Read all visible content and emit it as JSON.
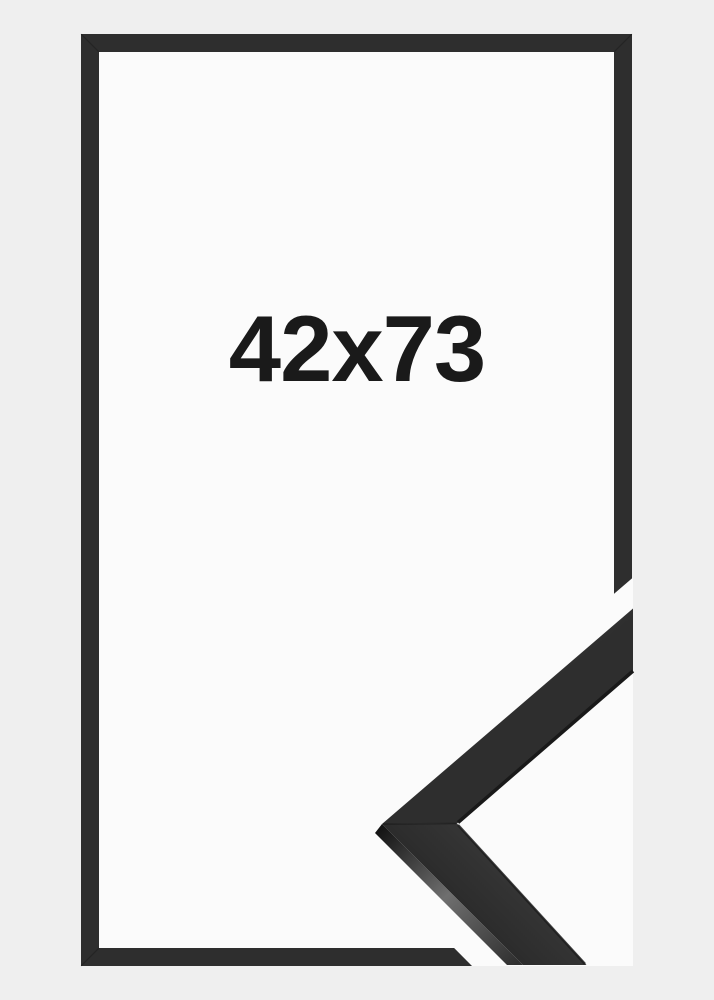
{
  "product_image": {
    "size_label": "42x73"
  },
  "colors": {
    "canvas_background": "#efefef",
    "frame_outline": "#2e2e2e",
    "frame_interior": "#fbfbfb",
    "label_text": "#1a1a1a",
    "moulding_face_light": "#3c3c3c",
    "moulding_face_dark": "#2b2b2b",
    "moulding_side_sheen": "#6f6f6f",
    "moulding_edge_shadow": "#181818"
  }
}
